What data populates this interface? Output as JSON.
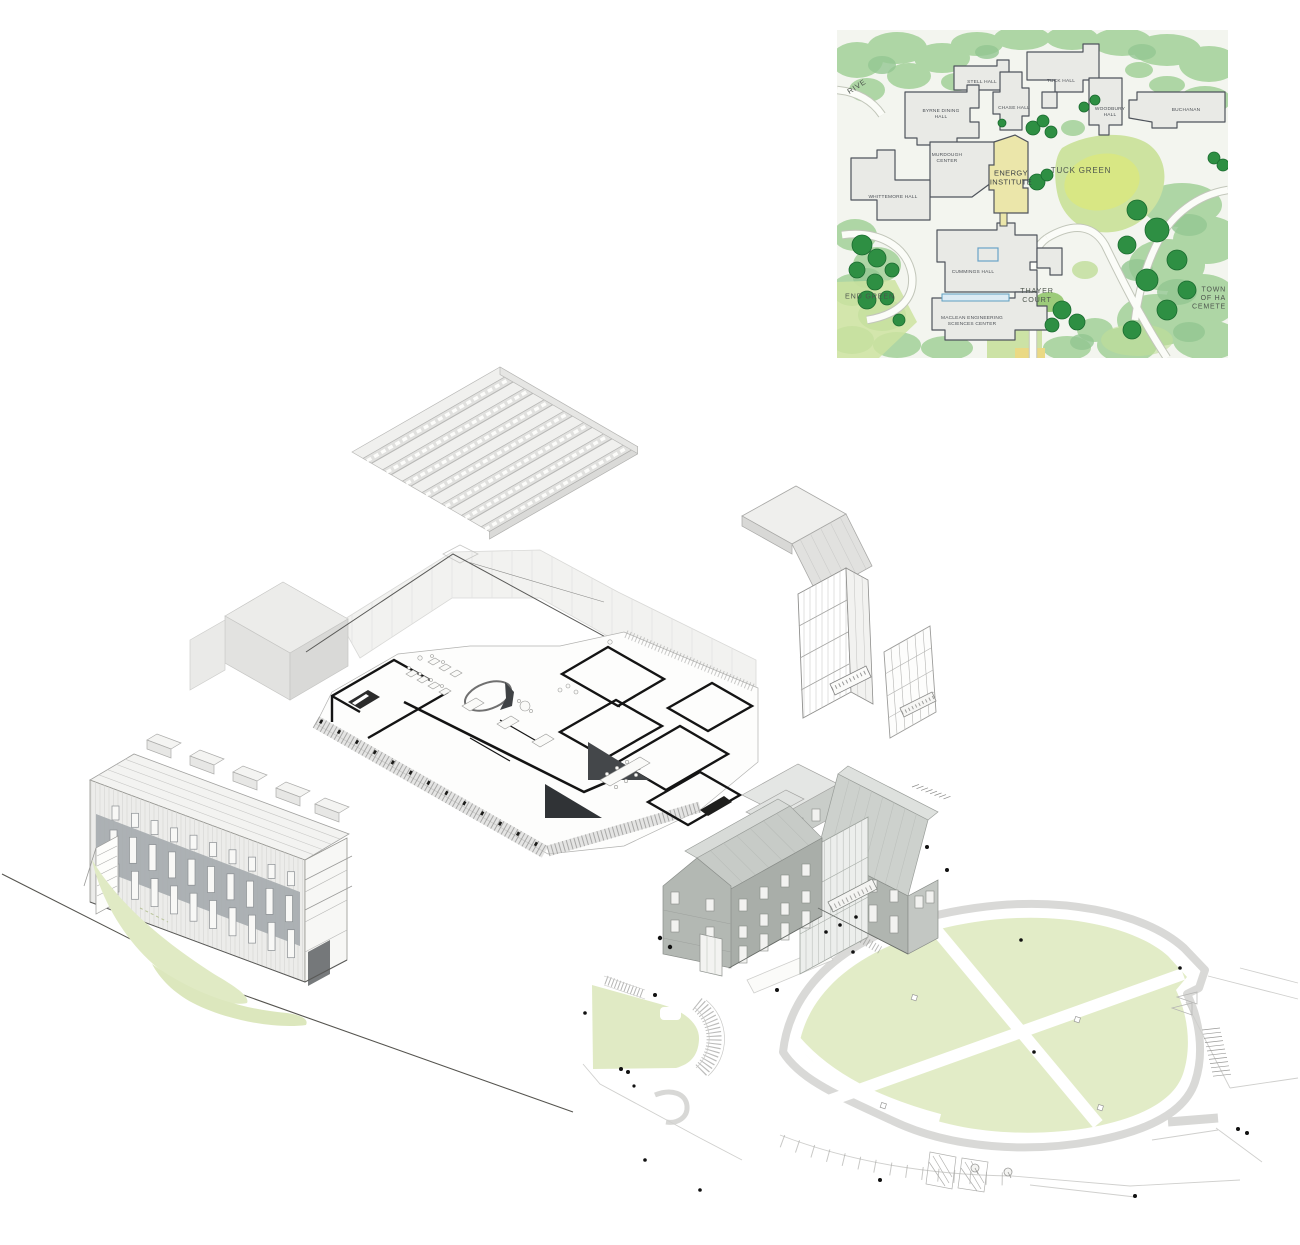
{
  "page": {
    "background": "#ffffff",
    "description": "Exploded axonometric architectural drawing with campus key map inset"
  },
  "campus_map": {
    "position": {
      "x": 837,
      "y": 30,
      "width": 391,
      "height": 328
    },
    "colors": {
      "paper": "#f3f5ef",
      "canopy_light": "#aed6a5",
      "canopy_mid": "#8fc690",
      "tree_dark": "#2e8f43",
      "tree_outline": "#1a6a2f",
      "lawn": "#cde3a0",
      "lawn_bright": "#dbe878",
      "building_fill": "#e9eae6",
      "building_stroke": "#4f545c",
      "highlight_fill": "#ebe6aa",
      "walkway_blue": "#5e9fc0",
      "label_color": "#4b4f55"
    },
    "labels": [
      {
        "id": "drive",
        "text": "RIVE",
        "x": 20,
        "y": 57,
        "size": 7.5,
        "rotate": -33,
        "style": "place"
      },
      {
        "id": "stell-hall",
        "text": "STELL HALL",
        "x": 145,
        "y": 52,
        "size": 4.8,
        "style": "building"
      },
      {
        "id": "tuck-hall",
        "text": "TUCK HALL",
        "x": 224,
        "y": 51,
        "size": 4.8,
        "style": "building"
      },
      {
        "id": "byrne-dining-hall",
        "text": "BYRNE DINING\nHALL",
        "x": 104,
        "y": 84,
        "size": 4.8,
        "style": "building"
      },
      {
        "id": "chase-hall",
        "text": "CHASE HALL",
        "x": 177,
        "y": 78,
        "size": 4.8,
        "style": "building"
      },
      {
        "id": "woodbury-hall",
        "text": "WOODBURY\nHALL",
        "x": 273,
        "y": 82,
        "size": 4.8,
        "style": "building"
      },
      {
        "id": "buchanan",
        "text": "BUCHANAN",
        "x": 349,
        "y": 80,
        "size": 4.8,
        "style": "building"
      },
      {
        "id": "murdough-center",
        "text": "MURDOUGH\nCENTER",
        "x": 110,
        "y": 128,
        "size": 4.8,
        "style": "building"
      },
      {
        "id": "energy-institute",
        "text": "ENERGY\nINSTITUTE",
        "x": 174,
        "y": 148,
        "size": 7.5,
        "style": "highlight"
      },
      {
        "id": "tuck-green",
        "text": "TUCK GREEN",
        "x": 244,
        "y": 141,
        "size": 8,
        "style": "place"
      },
      {
        "id": "whittemore-hall",
        "text": "WHITTEMORE HALL",
        "x": 56,
        "y": 167,
        "size": 4.8,
        "style": "building"
      },
      {
        "id": "cummings-hall",
        "text": "CUMMINGS HALL",
        "x": 136,
        "y": 242,
        "size": 4.8,
        "style": "building"
      },
      {
        "id": "end-green",
        "text": "END GREEN",
        "x": 33,
        "y": 267,
        "size": 7.2,
        "style": "place"
      },
      {
        "id": "thayer-court",
        "text": "THAYER\nCOURT",
        "x": 200,
        "y": 266,
        "size": 7.2,
        "style": "place"
      },
      {
        "id": "maclean-engineering",
        "text": "MACLEAN ENGINEERING\nSCIENCES CENTER",
        "x": 135,
        "y": 291,
        "size": 4.8,
        "style": "building"
      },
      {
        "id": "town-of-hanover-cemetery",
        "text": "TOWN OF HA\nCEMETE",
        "x": 389,
        "y": 268,
        "size": 7,
        "style": "place",
        "align": "right"
      }
    ]
  },
  "axon": {
    "colors": {
      "line_light": "#c2c2c0",
      "line_mid": "#9a9a98",
      "wall_black": "#141414",
      "shadow": "#3f4245",
      "lawn": "#e1ebc6",
      "building_gray": "#b3b8b3",
      "road_gray": "#d9d9d7"
    },
    "elements": [
      {
        "id": "sawtooth-roof-canopy",
        "desc": "exploded sawtooth skylight roof plane"
      },
      {
        "id": "upper-floor-ghost-volume",
        "desc": "ghosted upper storey massing"
      },
      {
        "id": "cutaway-floor-plan",
        "desc": "furnished cutaway floor plan with black poche walls"
      },
      {
        "id": "stair-tower",
        "desc": "glazed stair tower with folded canopy"
      },
      {
        "id": "curtain-wall-panel",
        "desc": "detached curtain wall facade panel"
      },
      {
        "id": "lab-building",
        "desc": "axonometric laboratory building with window grid and lawn swoosh"
      },
      {
        "id": "historic-hall-building",
        "desc": "gabled historic hall with glass link"
      },
      {
        "id": "site-plan",
        "desc": "ground plane with teardrop green, paths, parking and trees"
      }
    ]
  }
}
